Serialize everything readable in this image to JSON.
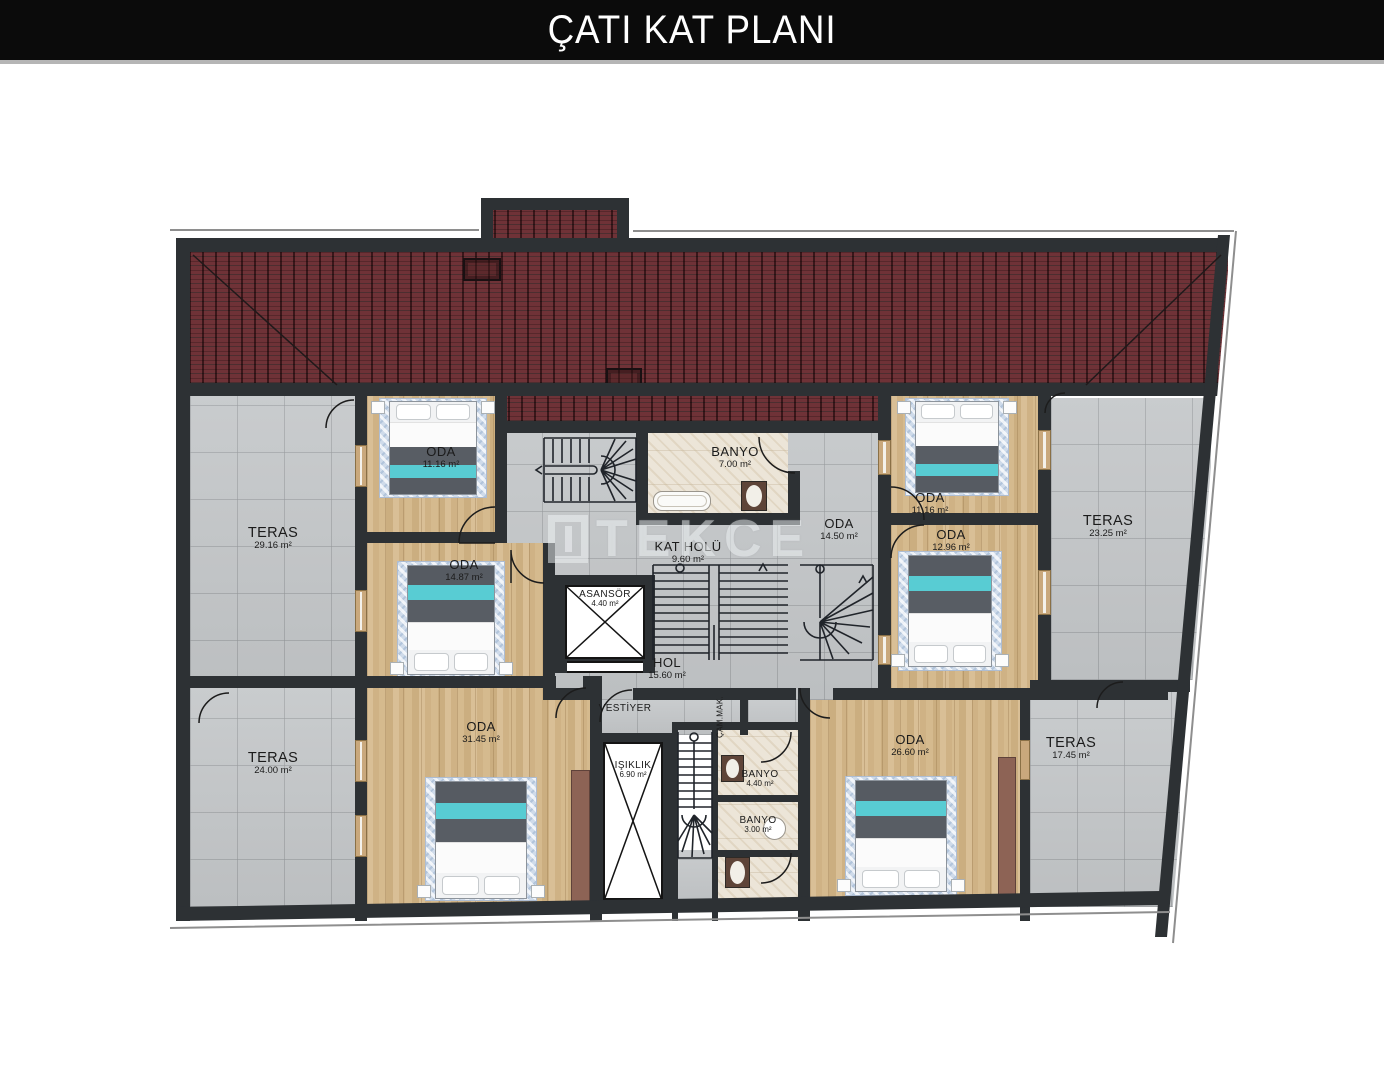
{
  "title": "ÇATI KAT PLANI",
  "watermark": "TEKCE",
  "colors": {
    "wall": "#2d3134",
    "roof_tile": "#6f3237",
    "terrace_tile": "#c6c9cb",
    "wood_floor": "#d3b78c",
    "bath_floor": "#ece5d8",
    "bed_teal": "#58ccd3",
    "title_bg": "#0b0b0b",
    "title_fg": "#ffffff"
  },
  "labels": {
    "teras_tl": {
      "name": "TERAS",
      "area": "29.16 m²"
    },
    "teras_bl": {
      "name": "TERAS",
      "area": "24.00 m²"
    },
    "teras_tr": {
      "name": "TERAS",
      "area": "23.25 m²"
    },
    "teras_br": {
      "name": "TERAS",
      "area": "17.45 m²"
    },
    "oda_tl": {
      "name": "ODA",
      "area": "11.16 m²"
    },
    "oda_ml": {
      "name": "ODA",
      "area": "14.87 m²"
    },
    "oda_bl": {
      "name": "ODA",
      "area": "31.45 m²"
    },
    "oda_tr": {
      "name": "ODA",
      "area": "11.16 m²"
    },
    "oda_mr": {
      "name": "ODA",
      "area": "12.96 m²"
    },
    "oda_br": {
      "name": "ODA",
      "area": "26.60 m²"
    },
    "oda_c": {
      "name": "ODA",
      "area": "14.50 m²"
    },
    "banyo_top": {
      "name": "BANYO",
      "area": "7.00 m²"
    },
    "banyo_mid": {
      "name": "BANYO",
      "area": "4.40 m²"
    },
    "banyo_low": {
      "name": "BANYO",
      "area": "3.00 m²"
    },
    "kat_holu": {
      "name": "KAT HOLÜ",
      "area": "9.60 m²"
    },
    "asansor": {
      "name": "ASANSÖR",
      "area": "4.40 m²"
    },
    "hol": {
      "name": "HOL",
      "area": "15.60 m²"
    },
    "isiklik": {
      "name": "IŞIKLIK",
      "area": "6.90 m²"
    },
    "vestiyer": {
      "name": "VESTİYER"
    },
    "cam_mak": {
      "name": "ÇAM.MAK."
    }
  }
}
